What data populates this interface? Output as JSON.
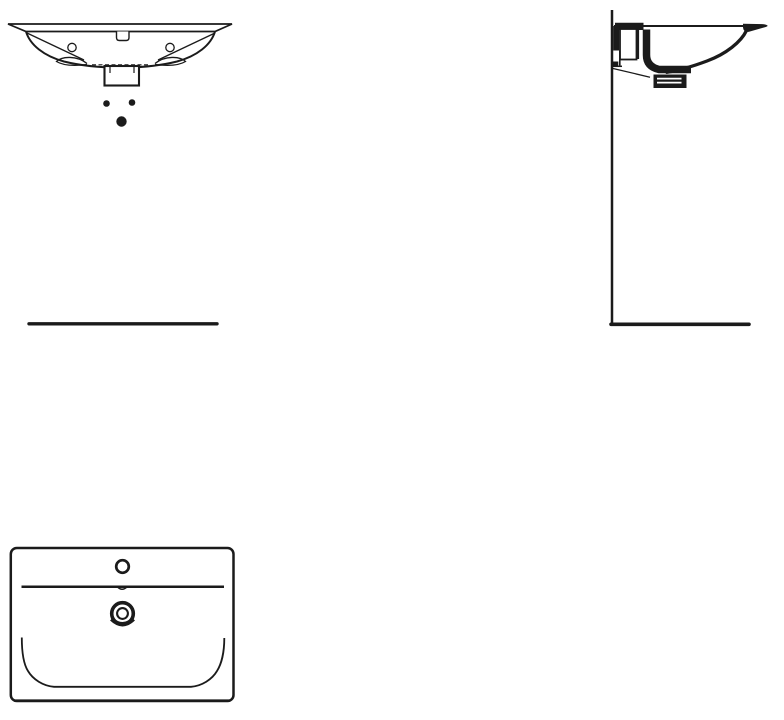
{
  "page": {
    "background_color": "#ffffff",
    "ink_color": "#1b1b1b"
  },
  "drawing": {
    "subject": "wall-hung-washbasin-technical-drawing",
    "views": [
      {
        "id": "front-elevation",
        "name": "front-elevation-view",
        "features": [
          "rim-bar",
          "basin-body-outline",
          "tap-hole-section",
          "fixing-hole-left",
          "fixing-hole-right",
          "outlet-box",
          "mounting-dot-left",
          "mounting-dot-right",
          "mounting-dot-center",
          "floor-line"
        ]
      },
      {
        "id": "side-profile",
        "name": "side-profile-section-view",
        "features": [
          "wall-line",
          "rim-top-line",
          "front-rim-section",
          "bowl-section-curve",
          "back-fixing-section",
          "outlet-flange-section",
          "floor-line"
        ]
      },
      {
        "id": "plan-view",
        "name": "plan-top-view",
        "features": [
          "outer-rim-outline",
          "tap-hole",
          "back-ledge-line",
          "center-notch",
          "overflow-drain-ring",
          "inner-bowl-outline"
        ]
      }
    ]
  }
}
